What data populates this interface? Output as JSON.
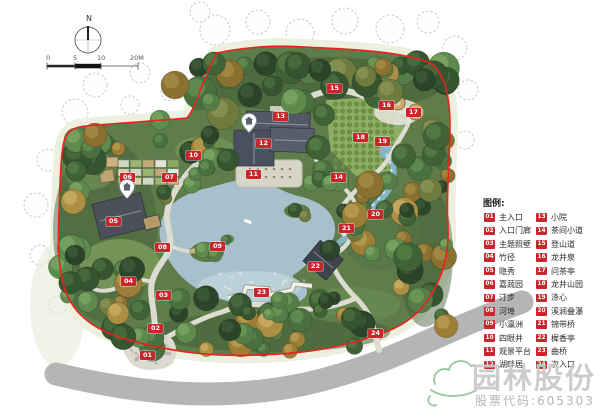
{
  "north": {
    "label": "N"
  },
  "scale": {
    "ticks": [
      "0",
      "5",
      "10",
      "20M"
    ]
  },
  "legend": {
    "title": "图例:",
    "columns": [
      {
        "items": [
          {
            "id": "01",
            "label": "主入口"
          },
          {
            "id": "02",
            "label": "入口门廊"
          },
          {
            "id": "03",
            "label": "主题照壁"
          },
          {
            "id": "04",
            "label": "竹径"
          },
          {
            "id": "05",
            "label": "隐秀"
          },
          {
            "id": "06",
            "label": "嘉蔬园"
          },
          {
            "id": "07",
            "label": "汀步"
          },
          {
            "id": "08",
            "label": "河埠"
          },
          {
            "id": "09",
            "label": "小瀛洲"
          },
          {
            "id": "10",
            "label": "四眼井"
          },
          {
            "id": "11",
            "label": "观景平台"
          },
          {
            "id": "12",
            "label": "湖畔居"
          }
        ]
      },
      {
        "items": [
          {
            "id": "13",
            "label": "小院"
          },
          {
            "id": "14",
            "label": "茶间小道"
          },
          {
            "id": "15",
            "label": "登山道"
          },
          {
            "id": "16",
            "label": "龙井泉"
          },
          {
            "id": "17",
            "label": "问茶亭"
          },
          {
            "id": "18",
            "label": "龙井山园"
          },
          {
            "id": "19",
            "label": "涤心"
          },
          {
            "id": "20",
            "label": "溪涧叠瀑"
          },
          {
            "id": "21",
            "label": "锦带桥"
          },
          {
            "id": "22",
            "label": "樨香亭"
          },
          {
            "id": "23",
            "label": "曲桥"
          },
          {
            "id": "24",
            "label": "次入口"
          }
        ]
      }
    ]
  },
  "map": {
    "markers": [
      {
        "id": "01",
        "x": 147,
        "y": 356
      },
      {
        "id": "02",
        "x": 155,
        "y": 329
      },
      {
        "id": "03",
        "x": 163,
        "y": 296
      },
      {
        "id": "04",
        "x": 128,
        "y": 282
      },
      {
        "id": "05",
        "x": 113,
        "y": 222
      },
      {
        "id": "06",
        "x": 127,
        "y": 178
      },
      {
        "id": "07",
        "x": 169,
        "y": 178
      },
      {
        "id": "08",
        "x": 162,
        "y": 248
      },
      {
        "id": "09",
        "x": 217,
        "y": 247
      },
      {
        "id": "10",
        "x": 193,
        "y": 156
      },
      {
        "id": "11",
        "x": 253,
        "y": 175
      },
      {
        "id": "12",
        "x": 263,
        "y": 144
      },
      {
        "id": "13",
        "x": 280,
        "y": 117
      },
      {
        "id": "14",
        "x": 338,
        "y": 178
      },
      {
        "id": "15",
        "x": 334,
        "y": 89
      },
      {
        "id": "16",
        "x": 386,
        "y": 106
      },
      {
        "id": "17",
        "x": 413,
        "y": 113
      },
      {
        "id": "18",
        "x": 360,
        "y": 138
      },
      {
        "id": "19",
        "x": 382,
        "y": 142
      },
      {
        "id": "20",
        "x": 375,
        "y": 215
      },
      {
        "id": "21",
        "x": 346,
        "y": 229
      },
      {
        "id": "22",
        "x": 315,
        "y": 267
      },
      {
        "id": "23",
        "x": 261,
        "y": 293
      },
      {
        "id": "24",
        "x": 375,
        "y": 334
      }
    ]
  },
  "watermark": {
    "brand": "园林股份",
    "stock": "股票代码:605303"
  },
  "colors": {
    "marker_red": "#c9252b",
    "boundary_red": "#e8231d",
    "pond_blue": "#a7c0cc",
    "pond_shallow": "#c0d4db",
    "stream_blue": "#85b4c6",
    "road_gray": "#b5b5b5",
    "path_gray": "#dcdcd0",
    "halo_cream": "#eef0df",
    "park_green": "#5f7d4b",
    "brand_gray": "#c8c8c8",
    "logo_green": "#a3c9a3"
  }
}
